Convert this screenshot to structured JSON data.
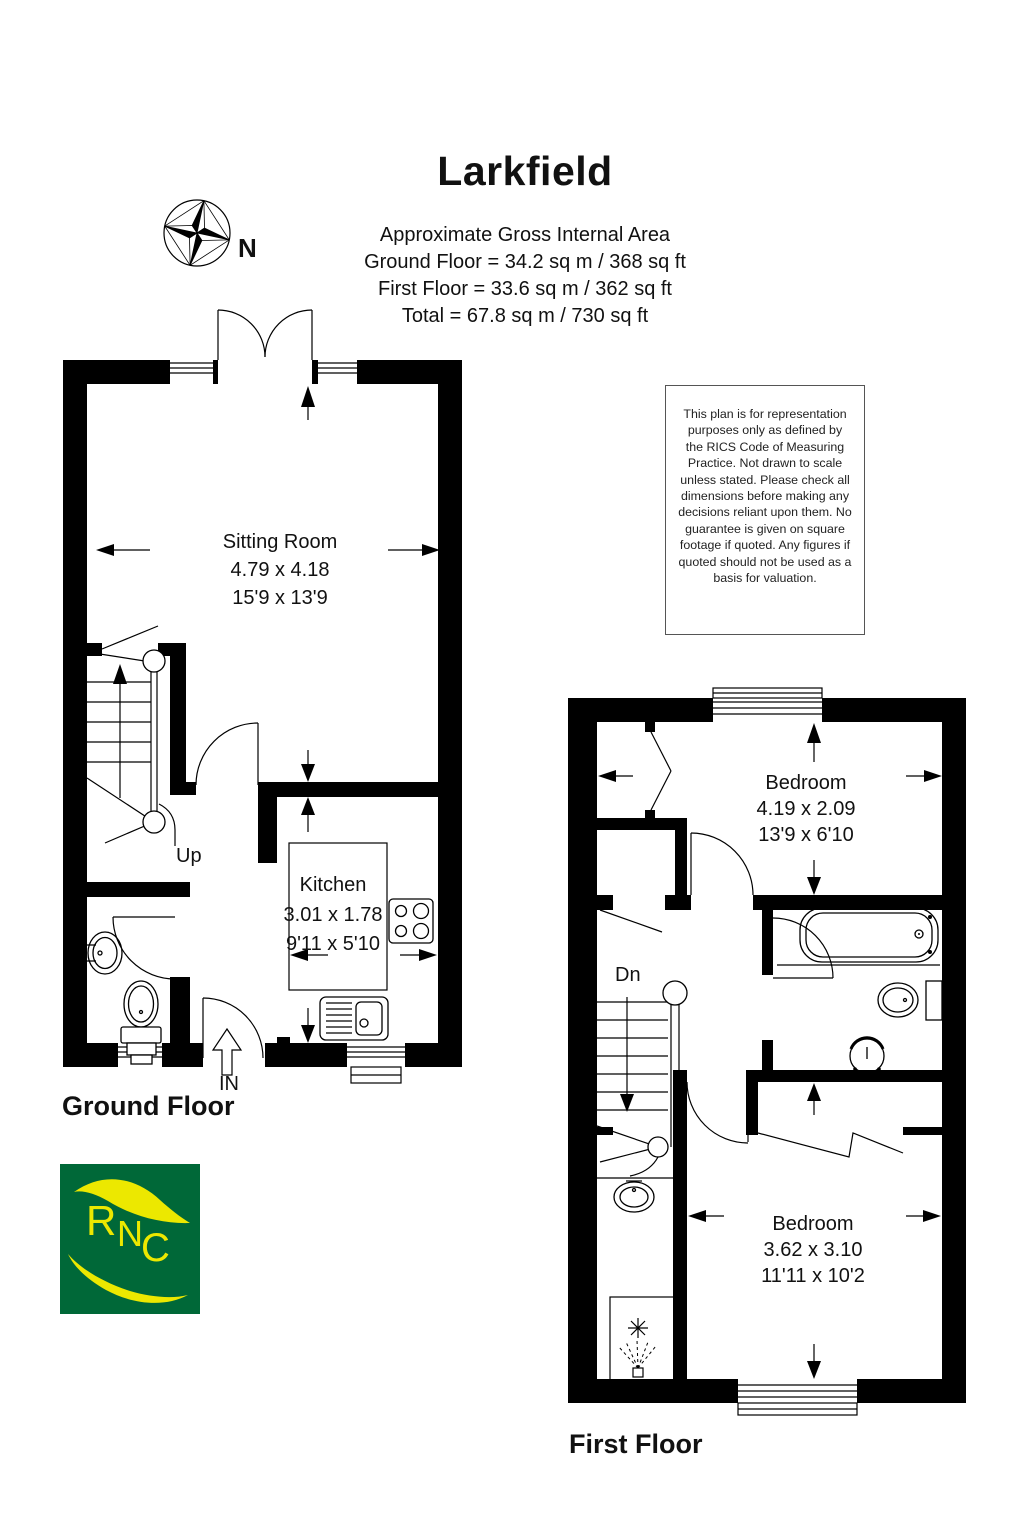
{
  "title": "Larkfield",
  "area": {
    "heading": "Approximate Gross Internal Area",
    "lines": [
      "Ground Floor = 34.2 sq m / 368 sq ft",
      "First Floor = 33.6 sq m / 362 sq ft",
      "Total = 67.8 sq m / 730 sq ft"
    ]
  },
  "compass": {
    "north_label": "N"
  },
  "disclaimer": {
    "text": "This plan is for representation purposes only as defined by the RICS Code of Measuring Practice. Not drawn to scale unless stated. Please check all dimensions before making any decisions reliant upon them. No guarantee is given on square footage if quoted. Any figures if quoted should not be used as a basis for valuation."
  },
  "ground_floor": {
    "label": "Ground Floor",
    "stairs_label": "Up",
    "entrance_label": "IN",
    "rooms": {
      "sitting_room": {
        "name": "Sitting Room",
        "metric": "4.79 x 4.18",
        "imperial": "15'9 x 13'9"
      },
      "kitchen": {
        "name": "Kitchen",
        "metric": "3.01 x 1.78",
        "imperial": "9'11 x 5'10"
      }
    }
  },
  "first_floor": {
    "label": "First Floor",
    "stairs_label": "Dn",
    "rooms": {
      "bedroom1": {
        "name": "Bedroom",
        "metric": "4.19 x 2.09",
        "imperial": "13'9 x 6'10"
      },
      "bedroom2": {
        "name": "Bedroom",
        "metric": "3.62 x 3.10",
        "imperial": "11'11 x 10'2"
      }
    }
  },
  "logo": {
    "letters": [
      "R",
      "N",
      "C"
    ],
    "green": "#006838",
    "yellow": "#ece800"
  }
}
